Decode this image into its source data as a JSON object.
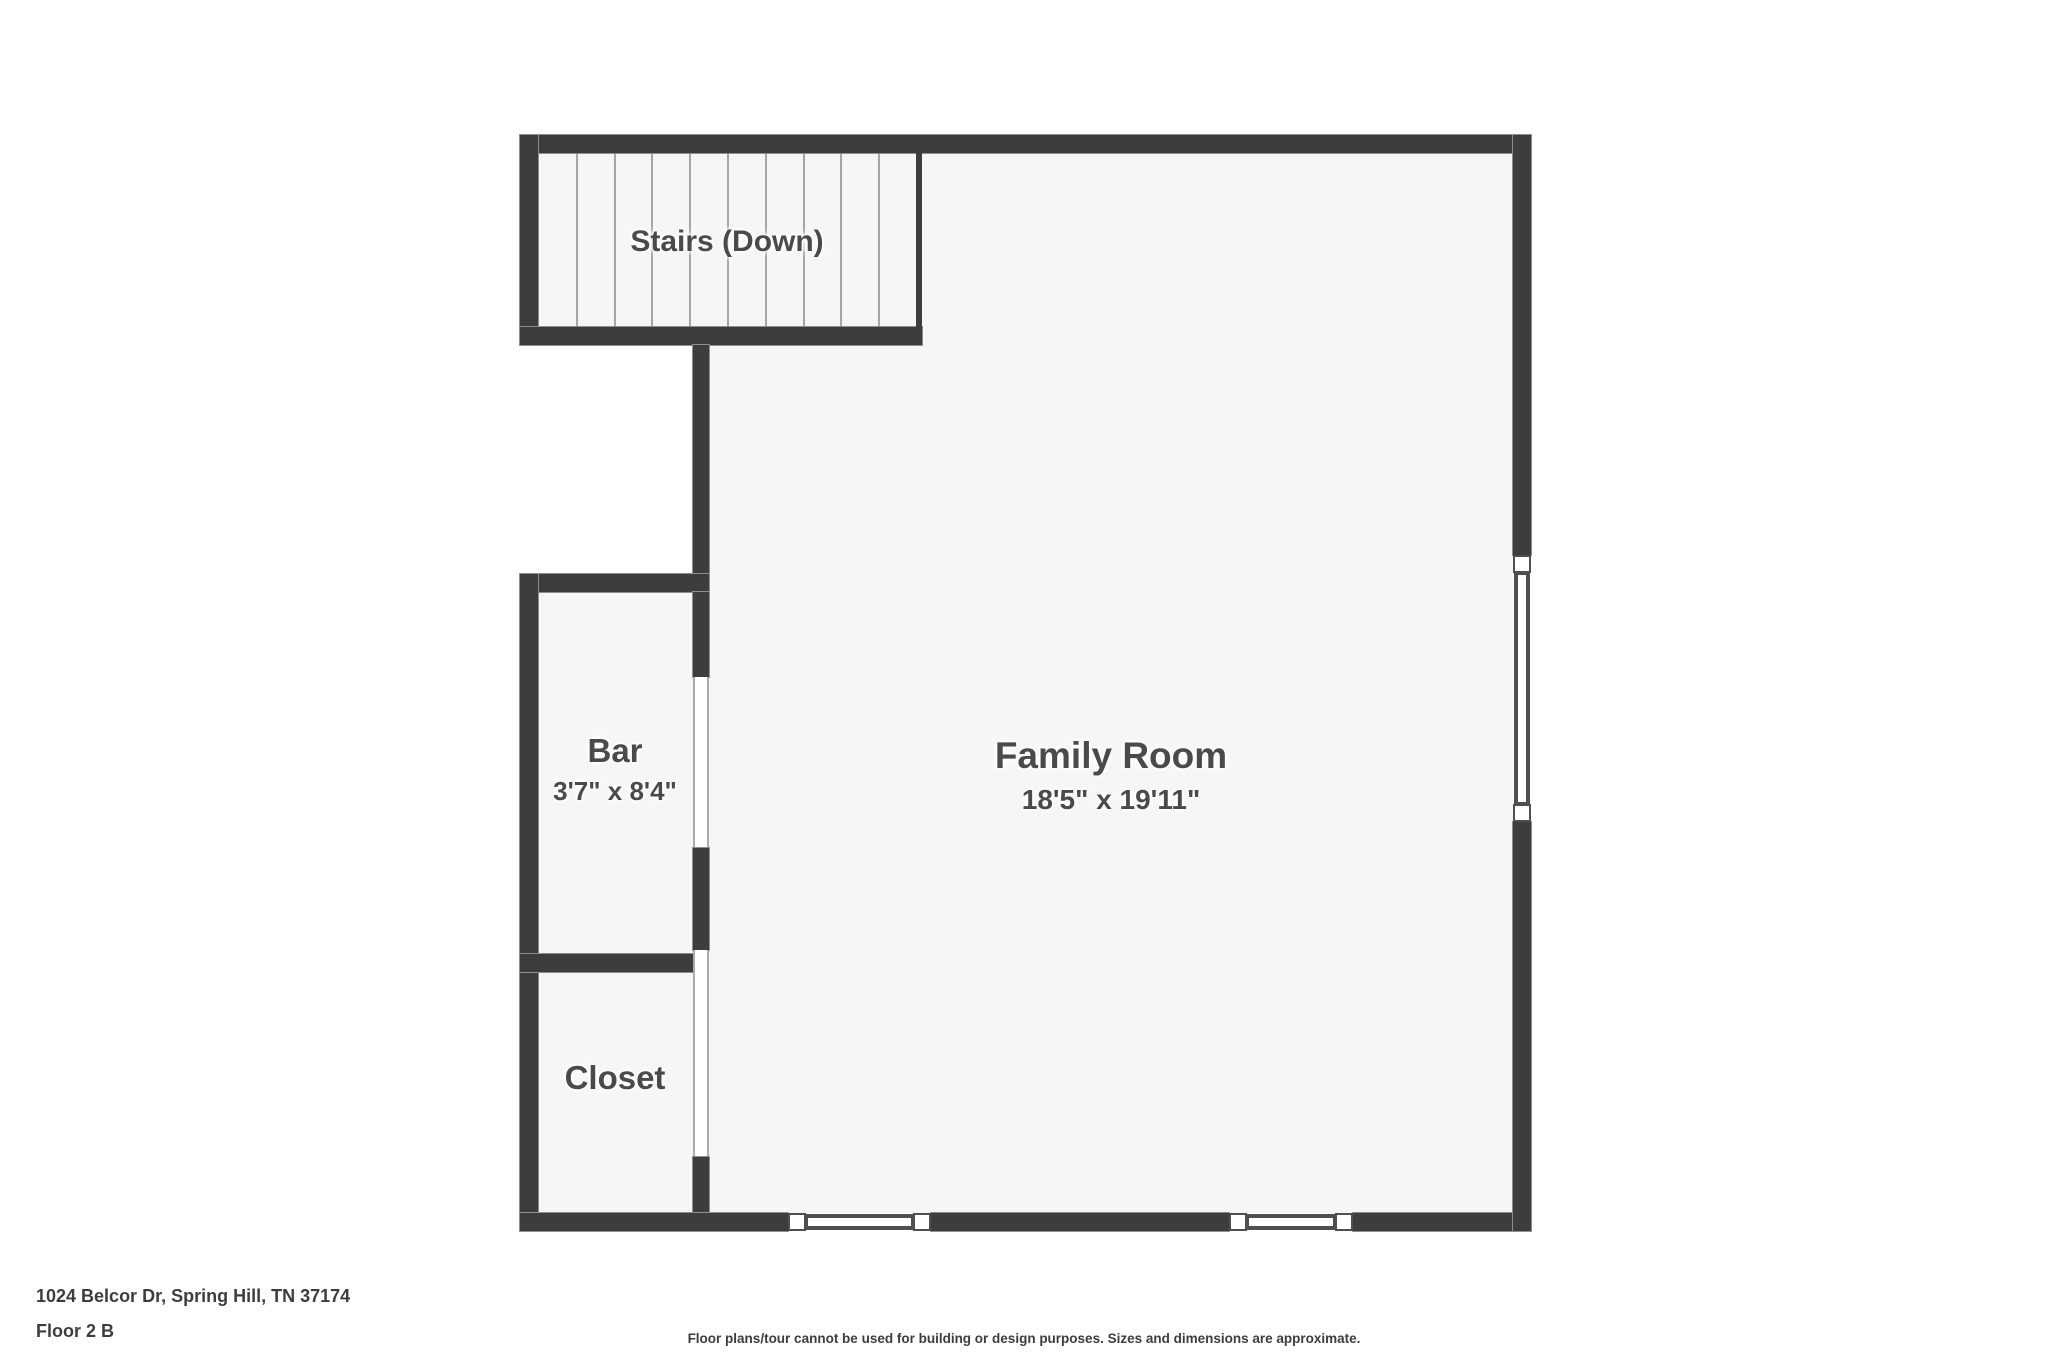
{
  "colors": {
    "page_bg": "#ffffff",
    "wall": "#3d3d3d",
    "wall_outline": "#8e8e8e",
    "room_fill": "#f6f6f6",
    "label_text": "#4a4a4a",
    "footer_text": "#3d3d3d",
    "tread_line": "#a6a6a6",
    "opening_jamb": "#ababab",
    "window_border": "#4f4f4f"
  },
  "rooms": {
    "stairs": {
      "label": "Stairs (Down)"
    },
    "family_room": {
      "label": "Family Room",
      "dimensions": "18'5\" x 19'11\""
    },
    "bar": {
      "label": "Bar",
      "dimensions": "3'7\" x 8'4\""
    },
    "closet": {
      "label": "Closet"
    }
  },
  "footer": {
    "address": "1024 Belcor Dr, Spring Hill, TN 37174",
    "floor_label": "Floor 2 B",
    "disclaimer": "Floor plans/tour cannot be used for building or design purposes. Sizes and dimensions are approximate."
  }
}
